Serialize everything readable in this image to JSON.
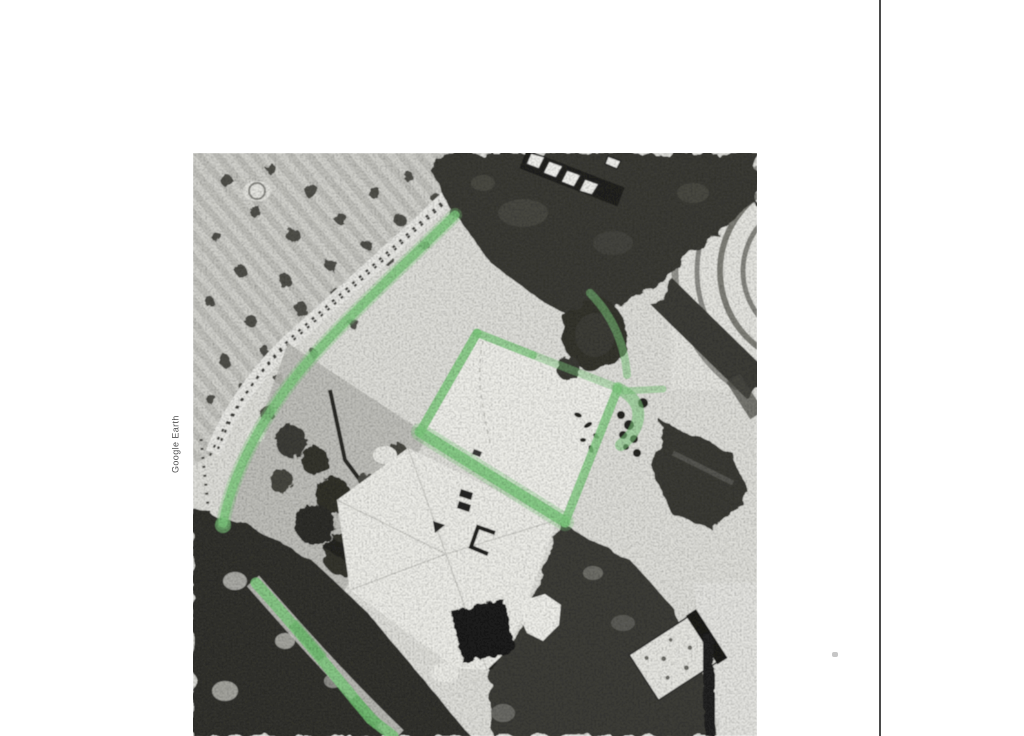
{
  "document": {
    "kind": "scanned page with printed aerial photograph",
    "credit_text": "Google Earth"
  },
  "colors": {
    "highlight": "#7ec97e",
    "page_edge": "#2b2b2b",
    "credit": "#3f3f3f",
    "speck": "#c6c6c6",
    "photo_base": "#e0e0db"
  }
}
